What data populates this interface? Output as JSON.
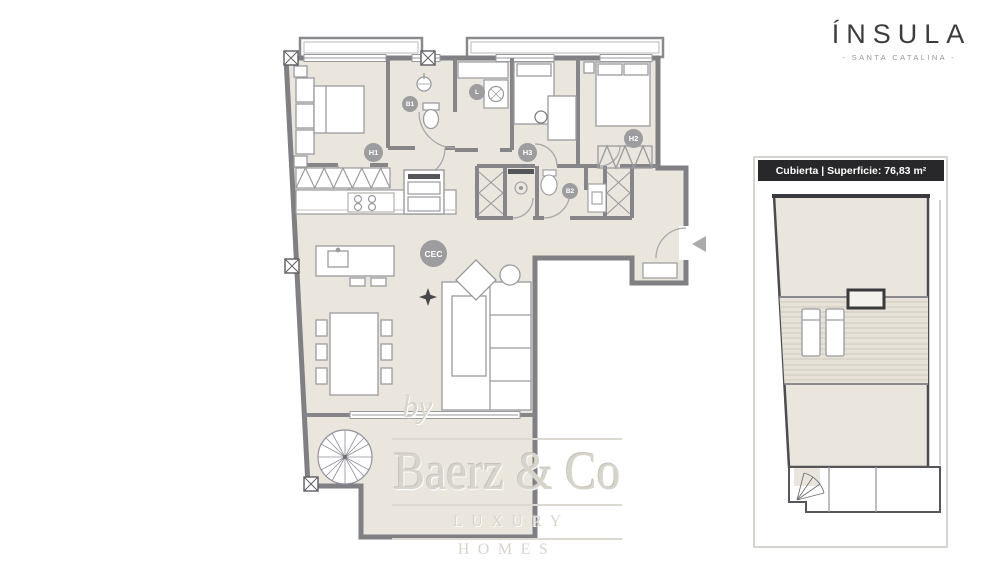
{
  "brand": {
    "name": "ÍNSULA",
    "subtitle": "- SANTA CATALINA -"
  },
  "watermark": {
    "prefix": "by",
    "name": "Baerz & Co",
    "tagline": "LUXURY HOMES"
  },
  "roof_panel": {
    "header": "Cubierta | Superficie: 76,83 m²"
  },
  "floor_plan": {
    "room_labels": {
      "h1": "H1",
      "b1": "B1",
      "l": "L",
      "h3": "H3",
      "h2": "H2",
      "b2": "B2",
      "cec": "CEC"
    }
  },
  "colors": {
    "floor": "#eae6dd",
    "wall": "#85858a",
    "label_bg": "#9d9d9f",
    "roof_header_bg": "#28282a",
    "brand_text": "#3d3d40",
    "watermark_text": "#d7d4cc",
    "background": "#ffffff"
  }
}
